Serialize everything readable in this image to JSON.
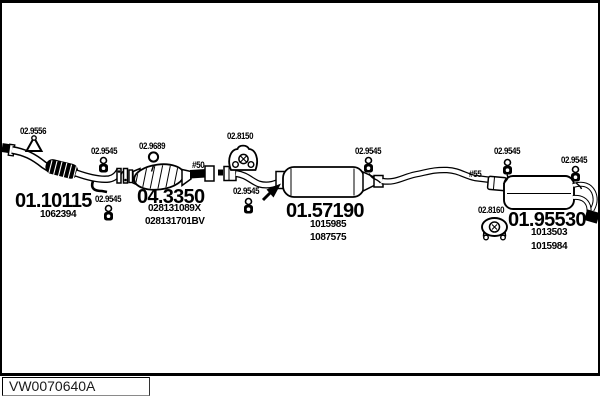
{
  "parts": {
    "front_pipe": {
      "code": "01.10115",
      "oem1": "1062394"
    },
    "catalyst": {
      "code": "04.3350",
      "oem1": "028131089X",
      "oem2": "028131701BV"
    },
    "mid_muffler": {
      "code": "01.57190",
      "oem1": "1015985",
      "oem2": "1087575"
    },
    "rear_muffler": {
      "code": "01.95530",
      "oem1": "1013503",
      "oem2": "1015984"
    }
  },
  "refs": {
    "r9556": "02.9556",
    "r9545": "02.9545",
    "r9689": "02.9689",
    "r8150": "02.8150",
    "r8160": "02.8160"
  },
  "markers": {
    "m50": "#50",
    "m55": "#55"
  },
  "footer": {
    "code": "VW0070640A"
  },
  "colors": {
    "line": "#000000",
    "background": "#ffffff"
  }
}
